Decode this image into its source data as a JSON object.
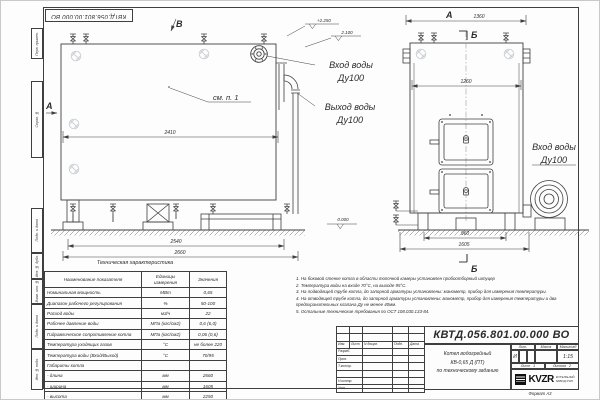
{
  "frame": {
    "stamp_top": "КВТД.056.801.00.000 ВО",
    "format_label": "Формат А3",
    "left_labels": [
      "Перв. примен.",
      "Справ. №",
      "Подп. и дата",
      "Инв. № дубл.",
      "Взам. инв. №",
      "Подп. и дата",
      "Инв. № подл."
    ]
  },
  "left_view": {
    "view_b": "В",
    "dir_a": "А",
    "callout_see": "см. п. 1",
    "dim_2410": "2410",
    "dim_2540": "2540",
    "dim_2660": "2660",
    "elev_2250": "+2.250",
    "elev_2100": "2.100",
    "elev_0": "0.000",
    "inlet_label": "Вход воды",
    "inlet_dn": "Ду100",
    "outlet_label": "Выход воды",
    "outlet_dn": "Ду100"
  },
  "right_view": {
    "view_a": "А",
    "dim_1360": "1360",
    "section_b_top": "Б",
    "dim_1260": "1260",
    "inlet_label": "Вход воды",
    "inlet_dn": "Ду100",
    "dim_960": "960",
    "dim_1605": "1605",
    "section_b_bottom": "Б"
  },
  "tech_table": {
    "title": "Техническая характеристика",
    "headers": [
      "Наименование показателя",
      "Единицы\nизмерения",
      "Значения"
    ],
    "rows": [
      [
        "Номинальная мощность",
        "МВт",
        "0,65"
      ],
      [
        "Диапазон рабочего регулирования",
        "%",
        "50-100"
      ],
      [
        "Расход воды",
        "м3/ч",
        "22"
      ],
      [
        "Рабочее давление воды",
        "МПа (кгс/см2)",
        "0,6 (6,0)"
      ],
      [
        "Гидравлическое сопротивление котла",
        "МПа (кгс/см2)",
        "0,06 (0,6)"
      ],
      [
        "Температура уходящих газов",
        "°С",
        "не более 220"
      ],
      [
        "Температура воды (Вход/Выход)",
        "°С",
        "70/95"
      ],
      [
        "Габариты котла",
        "",
        ""
      ],
      [
        "   - длина",
        "мм",
        "2660"
      ],
      [
        "   - ширина",
        "мм",
        "1605"
      ],
      [
        "   - высота",
        "мм",
        "2250"
      ]
    ]
  },
  "notes": [
    "1.  На боковой стенке котла в области топочной камеры установлен пробоотборный штуцер",
    "2.  Температура воды на входе 70°С, на выходе 95°С.",
    "3.  На подводящей трубе котла, до запорной арматуры установлены: манометр, прибор для измерения температуры.",
    "4.  На отводящей трубе котла, до запорной арматуры установлены: манометр, прибор для измерения температуры и два предохранительных клапана Ду не менее 40мм.",
    "5.  Остальные технические требования по ОСТ  108.030.133-84."
  ],
  "title_block": {
    "doc_number": "КВТД.056.801.00.000  ВО",
    "name_line1": "Котел водогрейный",
    "name_line2": "КВ-0,65 Д (ПТ)",
    "name_line3": "по техническому заданию",
    "header_cols": [
      "Изм.",
      "Лист",
      "N докум.",
      "Подп.",
      "Дата"
    ],
    "row_labels": [
      "Разраб.",
      "Пров.",
      "Т.контр.",
      "",
      "Н.контр.",
      "Утв."
    ],
    "lit_header": "Лит.",
    "lit_value": "И",
    "mass_header": "Масса",
    "scale_header": "Масштаб",
    "scale_value": "1:15",
    "sheet_label": "Лист",
    "sheet_value": "1",
    "sheets_label": "Листов",
    "sheets_value": "2",
    "logo_text": "KVZR",
    "company_line1": "КОТЕЛЬНЫЙ",
    "company_line2": "ЗАВОД РЭП"
  }
}
